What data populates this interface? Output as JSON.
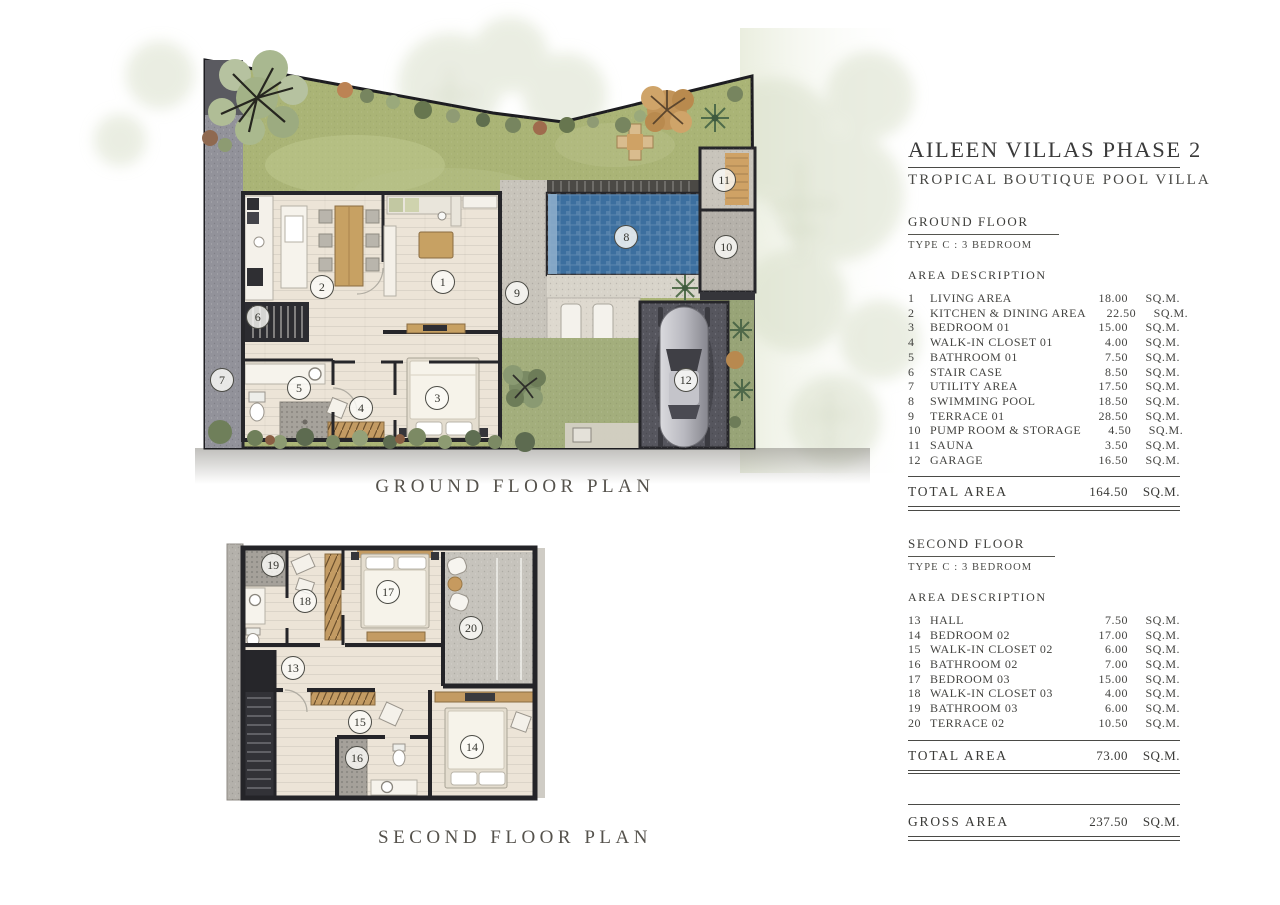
{
  "header": {
    "title": "AILEEN VILLAS PHASE 2",
    "subtitle": "TROPICAL BOUTIQUE POOL VILLA"
  },
  "plans": {
    "ground": {
      "caption": "GROUND FLOOR PLAN",
      "markers": [
        {
          "n": "1",
          "x": 36.7,
          "y": 55.4
        },
        {
          "n": "2",
          "x": 18.8,
          "y": 56.5
        },
        {
          "n": "3",
          "x": 35.9,
          "y": 80.9
        },
        {
          "n": "4",
          "x": 24.6,
          "y": 83.1
        },
        {
          "n": "5",
          "x": 15.4,
          "y": 78.7
        },
        {
          "n": "6",
          "x": 9.3,
          "y": 63.1
        },
        {
          "n": "7",
          "x": 4.0,
          "y": 76.9
        },
        {
          "n": "8",
          "x": 63.9,
          "y": 45.5
        },
        {
          "n": "9",
          "x": 47.7,
          "y": 57.8
        },
        {
          "n": "10",
          "x": 78.7,
          "y": 47.7
        },
        {
          "n": "11",
          "x": 78.4,
          "y": 33.0
        },
        {
          "n": "12",
          "x": 72.7,
          "y": 76.9
        }
      ]
    },
    "second": {
      "caption": "SECOND FLOOR PLAN",
      "markers": [
        {
          "n": "13",
          "x": 20.9,
          "y": 47.8
        },
        {
          "n": "14",
          "x": 76.0,
          "y": 77.2
        },
        {
          "n": "15",
          "x": 41.5,
          "y": 67.9
        },
        {
          "n": "16",
          "x": 40.6,
          "y": 81.3
        },
        {
          "n": "17",
          "x": 50.2,
          "y": 19.4
        },
        {
          "n": "18",
          "x": 24.6,
          "y": 22.8
        },
        {
          "n": "19",
          "x": 14.8,
          "y": 9.3
        },
        {
          "n": "20",
          "x": 75.7,
          "y": 32.8
        }
      ]
    }
  },
  "ground_floor": {
    "section_title": "GROUND FLOOR",
    "type_label": "TYPE C : 3 BEDROOM",
    "table_header": "AREA DESCRIPTION",
    "rows": [
      {
        "num": "1",
        "name": "LIVING AREA",
        "value": "18.00",
        "unit": "SQ.M."
      },
      {
        "num": "2",
        "name": "KITCHEN & DINING AREA",
        "value": "22.50",
        "unit": "SQ.M."
      },
      {
        "num": "3",
        "name": "BEDROOM 01",
        "value": "15.00",
        "unit": "SQ.M."
      },
      {
        "num": "4",
        "name": "WALK-IN CLOSET 01",
        "value": "4.00",
        "unit": "SQ.M."
      },
      {
        "num": "5",
        "name": "BATHROOM 01",
        "value": "7.50",
        "unit": "SQ.M."
      },
      {
        "num": "6",
        "name": "STAIR CASE",
        "value": "8.50",
        "unit": "SQ.M."
      },
      {
        "num": "7",
        "name": "UTILITY AREA",
        "value": "17.50",
        "unit": "SQ.M."
      },
      {
        "num": "8",
        "name": "SWIMMING POOL",
        "value": "18.50",
        "unit": "SQ.M."
      },
      {
        "num": "9",
        "name": "TERRACE 01",
        "value": "28.50",
        "unit": "SQ.M."
      },
      {
        "num": "10",
        "name": "PUMP ROOM & STORAGE",
        "value": "4.50",
        "unit": "SQ.M."
      },
      {
        "num": "11",
        "name": "SAUNA",
        "value": "3.50",
        "unit": "SQ.M."
      },
      {
        "num": "12",
        "name": "GARAGE",
        "value": "16.50",
        "unit": "SQ.M."
      }
    ],
    "total": {
      "label": "TOTAL AREA",
      "value": "164.50",
      "unit": "SQ.M."
    }
  },
  "second_floor": {
    "section_title": "SECOND FLOOR",
    "type_label": "TYPE C : 3 BEDROOM",
    "table_header": "AREA DESCRIPTION",
    "rows": [
      {
        "num": "13",
        "name": "HALL",
        "value": "7.50",
        "unit": "SQ.M."
      },
      {
        "num": "14",
        "name": "BEDROOM 02",
        "value": "17.00",
        "unit": "SQ.M."
      },
      {
        "num": "15",
        "name": "WALK-IN CLOSET 02",
        "value": "6.00",
        "unit": "SQ.M."
      },
      {
        "num": "16",
        "name": "BATHROOM 02",
        "value": "7.00",
        "unit": "SQ.M."
      },
      {
        "num": "17",
        "name": "BEDROOM 03",
        "value": "15.00",
        "unit": "SQ.M."
      },
      {
        "num": "18",
        "name": "WALK-IN CLOSET 03",
        "value": "4.00",
        "unit": "SQ.M."
      },
      {
        "num": "19",
        "name": "BATHROOM 03",
        "value": "6.00",
        "unit": "SQ.M."
      },
      {
        "num": "20",
        "name": "TERRACE 02",
        "value": "10.50",
        "unit": "SQ.M."
      }
    ],
    "total": {
      "label": "TOTAL AREA",
      "value": "73.00",
      "unit": "SQ.M."
    }
  },
  "gross": {
    "label": "GROSS AREA",
    "value": "237.50",
    "unit": "SQ.M."
  },
  "colors": {
    "pool_water": "#3c6f9f",
    "grass": "#aab476",
    "wood_floor": "#ece4d7",
    "wall": "#26262a",
    "furniture_wood": "#c39b63",
    "concrete": "#c8c4bb",
    "text": "#3c3c3c"
  }
}
